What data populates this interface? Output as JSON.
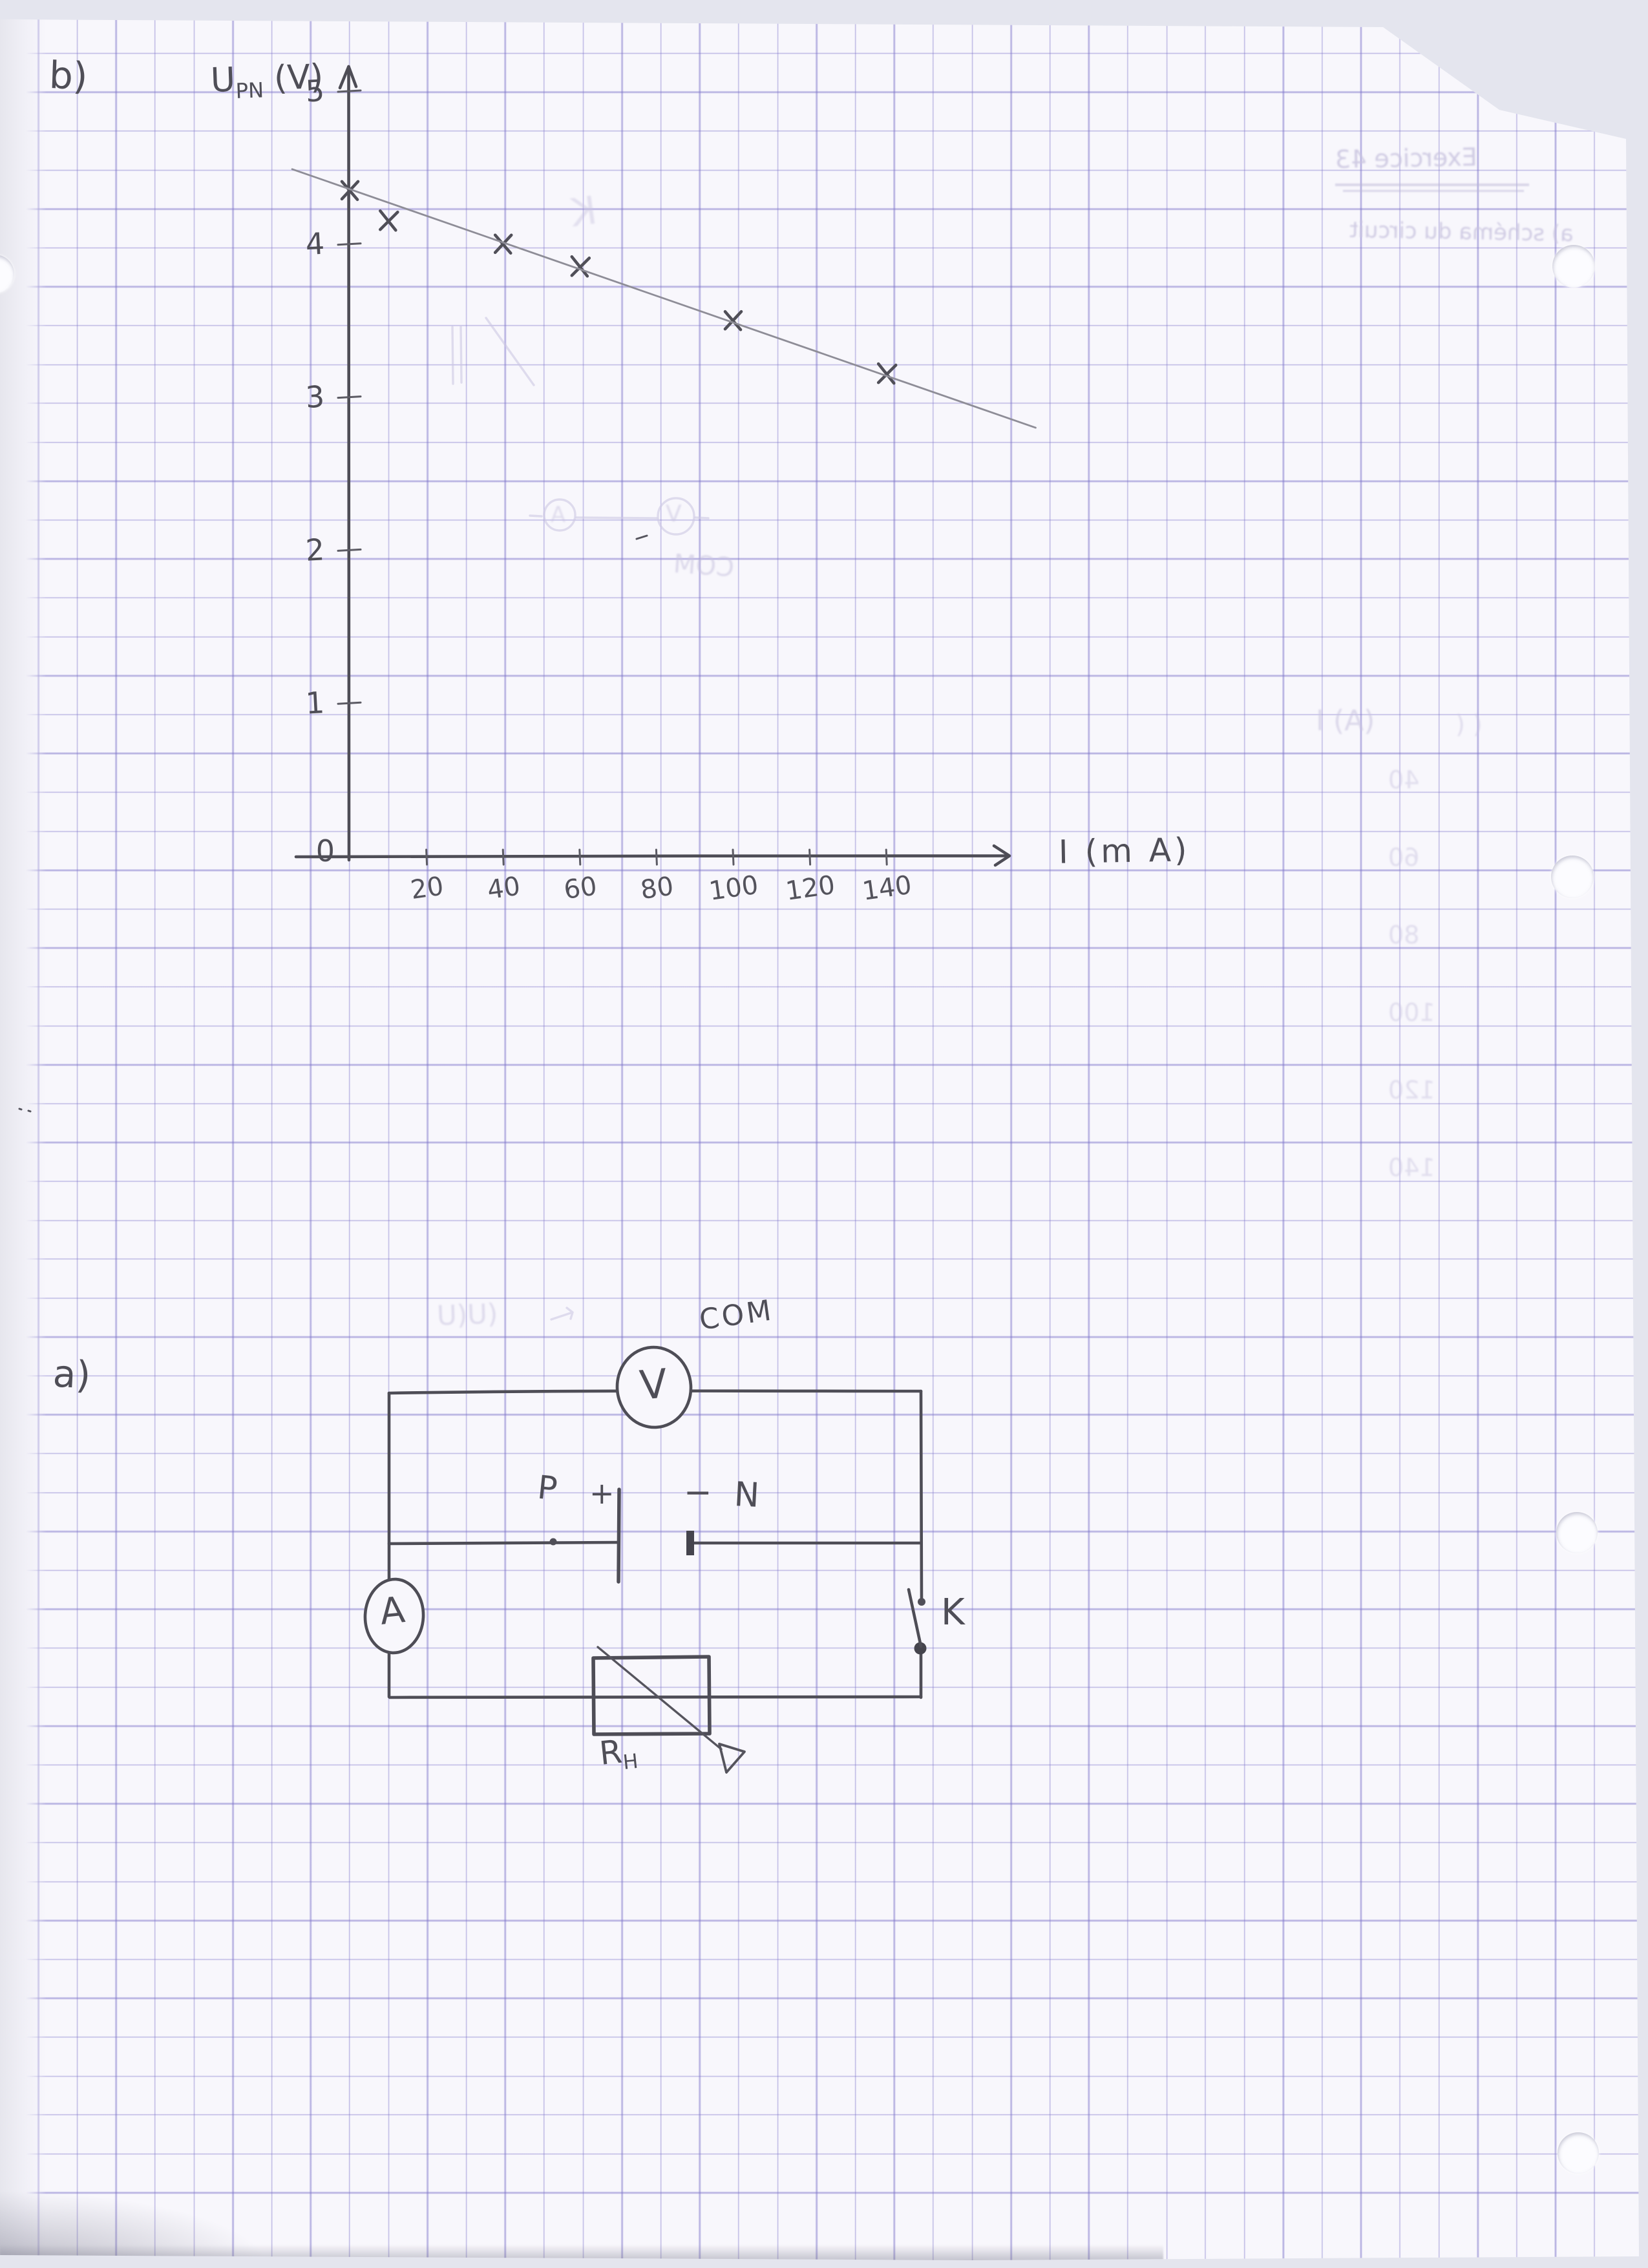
{
  "page": {
    "section_b_label": "b)",
    "section_a_label": "a)"
  },
  "chart_data": {
    "type": "scatter",
    "marker": "x",
    "title": "",
    "ylabel_base": "U",
    "ylabel_sub": "PN",
    "ylabel_unit": "(V)",
    "xlabel": "I (m A)",
    "origin_label": "0",
    "y_ticks": [
      1,
      2,
      3,
      4,
      5
    ],
    "x_ticks": [
      20,
      40,
      60,
      80,
      100,
      120,
      140
    ],
    "xlim": [
      0,
      170
    ],
    "ylim": [
      0,
      5.3
    ],
    "grid": true,
    "legend": null,
    "points": [
      {
        "I": 0,
        "U": 4.35
      },
      {
        "I": 10,
        "U": 4.15
      },
      {
        "I": 40,
        "U": 4.0
      },
      {
        "I": 60,
        "U": 3.85
      },
      {
        "I": 100,
        "U": 3.5
      },
      {
        "I": 140,
        "U": 3.15
      }
    ],
    "fit_line": {
      "x1": -15,
      "y1": 4.49,
      "x2": 179,
      "y2": 2.8
    }
  },
  "circuit": {
    "com_label": "COM",
    "voltmeter_label": "V",
    "ammeter_label": "A",
    "battery_positive_label": "P",
    "plus_sign": "+",
    "minus_sign": "−",
    "battery_negative_label": "N",
    "switch_label": "K",
    "rheostat_label": "R",
    "rheostat_label_sub": "H"
  },
  "ghosts": {
    "line1": "Exercice 43",
    "line2": "a) schéma du circuit",
    "k": "K",
    "col_header": "(A) I",
    "col_values": [
      "40",
      "60",
      "80",
      "100",
      "120",
      "140"
    ],
    "uu": "(U(U",
    "com_mirror": "COM",
    "v_mirror": "V",
    "a_mirror": "A",
    "paren": "( ("
  }
}
